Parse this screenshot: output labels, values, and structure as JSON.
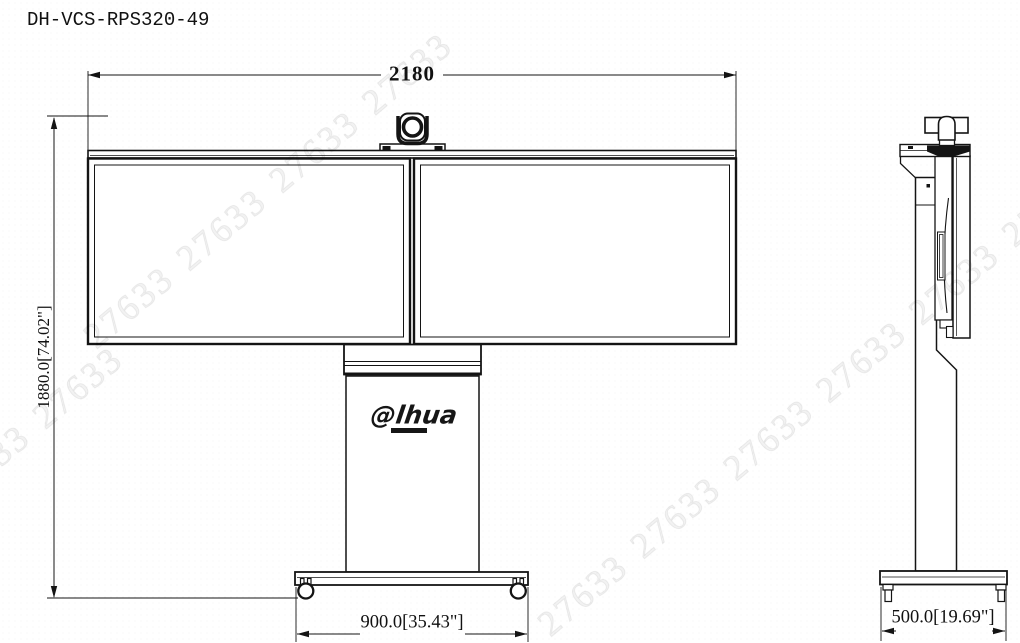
{
  "title": "DH-VCS-RPS320-49",
  "dimensions": {
    "overall_width": "2180",
    "overall_height": "1880.0[74.02\"]",
    "front_base_width": "900.0[35.43\"]",
    "side_base_depth": "500.0[19.69\"]"
  },
  "logo": {
    "text": "@lhua"
  },
  "watermark": {
    "text": "27633",
    "color": "#000000",
    "opacity": 0.05
  },
  "drawing": {
    "line_color": "#141414",
    "background_color": "#ffffff"
  }
}
